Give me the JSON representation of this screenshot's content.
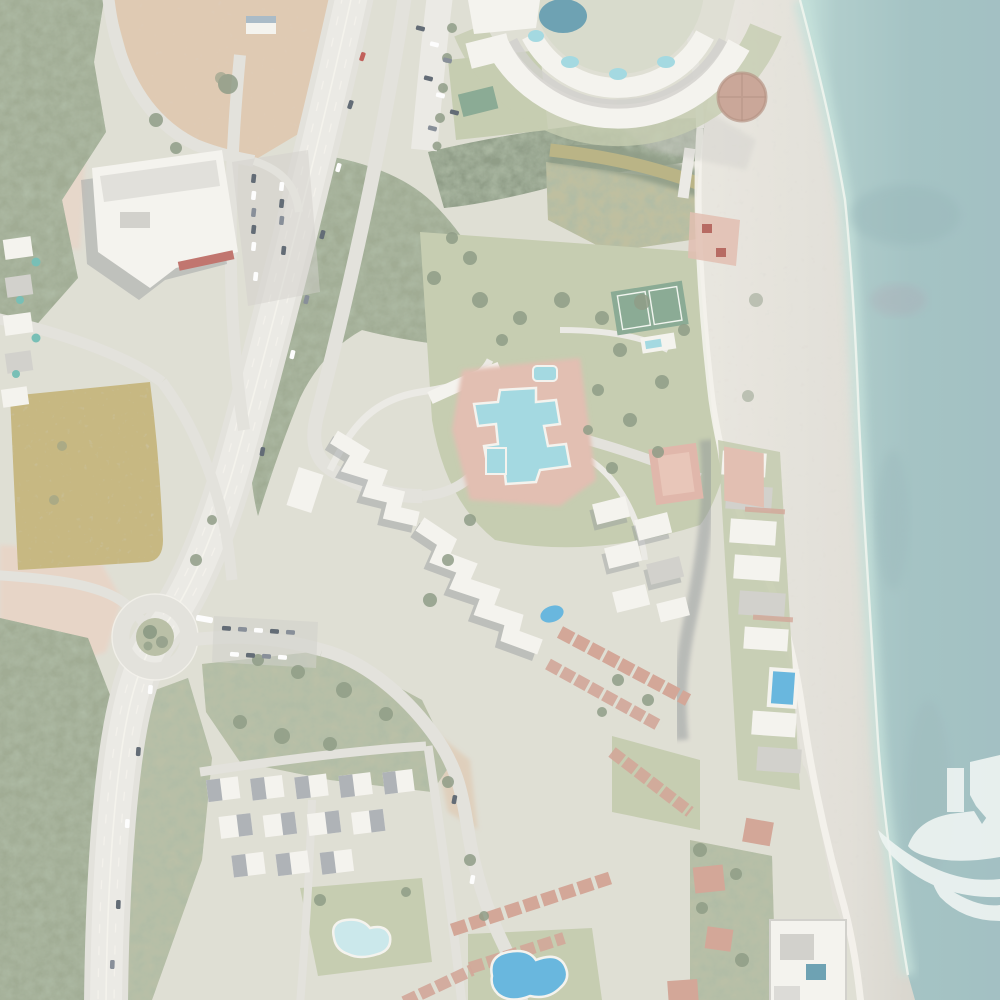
{
  "scene": {
    "type": "aerial-satellite-photograph",
    "description": "Washed-out aerial/satellite view of a Mediterranean beachfront resort town: teal sea and wide grey beach on the right, beachfront apartment rows with pools, a crescent-shaped resort complex at top, a central resort with a large free-form lagoon pool, a divided highway sweeping from top to bottom-left through a roundabout, an olive-green sports field, woods, dirt lots, and dense white housing clusters at the bottom. A white boat-and-waves watermark logo sits at the bottom-right edge over the water.",
    "orientation": "sea-on-right",
    "visible_text": "none"
  },
  "palette": {
    "land": "#d8d7ca",
    "woods": "#8a987a",
    "woods_dark": "#74856a",
    "scrub": "#a9b192",
    "grass": "#b8c19e",
    "lawn": "#c3c9a8",
    "field": "#b9a763",
    "marsh": "#b0b089",
    "dirt_tan": "#d8bda0",
    "dirt_pink": "#e2cbba",
    "road": "#dcdbd4",
    "road_lite": "#e7e5df",
    "paint_white": "#f2f0e8",
    "building_white": "#f2f0ea",
    "roof_gray": "#c7c6c0",
    "roof_dark": "#9ba1a6",
    "terracotta": "#c8917f",
    "shadow": "#6e767b",
    "pool_cyan": "#8ed0da",
    "pool_blue": "#44a6d6",
    "pool_navy": "#4a8ba0",
    "pool_teal": "#57b0a4",
    "river": "#a9a268",
    "beach": "#e0ddd4",
    "beach_wet": "#cfccc2",
    "sea_deep": "#8fb5b6",
    "sea_mid": "#9dc1bf",
    "sea_shallow": "#b7dad2",
    "foam": "#eef3ec",
    "accent_red": "#b23a32"
  },
  "overlay": {
    "haze_color": "#ffffff",
    "haze_opacity": "0.20"
  },
  "watermark": {
    "shape": "boat-with-waves-logo",
    "fill": "#edf3f1",
    "opacity": "0.92",
    "position": "bottom-right, clipped by right edge"
  },
  "features": {
    "sea": {
      "label": "Teal sea water with darker seagrass patches"
    },
    "shoreline": {
      "label": "Shoreline foam line"
    },
    "beach": {
      "label": "Wide grey sand and gravel beach"
    },
    "promenade": {
      "label": "Beach promenade path"
    },
    "river": {
      "label": "Brown-green stream reaching the beach"
    },
    "marsh": {
      "label": "Reedy marsh south of the stream"
    },
    "woods": {
      "label": "Dense dark-green woodland"
    },
    "field": {
      "label": "Olive-green sports field"
    },
    "dirt": {
      "label": "Bare earth construction lot"
    },
    "highway": {
      "label": "Divided highway curving from top to bottom-left"
    },
    "roundabout": {
      "label": "Roundabout with planted centre island"
    },
    "roads": {
      "label": "Local access roads"
    },
    "supermarket": {
      "label": "White flat-roof supermarket with car park"
    },
    "supermarket_parking": {
      "label": "Supermarket parking rows with cars"
    },
    "circular_resort": {
      "label": "Crescent-shaped resort building with terrace pools"
    },
    "round_plaza": {
      "label": "Round brown plaza structure"
    },
    "central_resort": {
      "label": "Zig-zag white resort apartment blocks"
    },
    "lagoon_pool": {
      "label": "Large free-form turquoise lagoon pool with pink deck"
    },
    "tennis_courts": {
      "label": "Green tennis courts"
    },
    "paddle_courts": {
      "label": "Salmon-pink sports courts"
    },
    "beachfront_row": {
      "label": "Row of beachfront apartment blocks"
    },
    "beachfront_pool": {
      "label": "Rectangular bright-blue beachfront pool"
    },
    "bottom_left_apartments": {
      "label": "Grid of white apartment blocks with dark roofs"
    },
    "kidney_pool": {
      "label": "Pale-blue kidney-shaped pool in lawn"
    },
    "freeform_pool": {
      "label": "Bright-blue free-form pool at bottom centre"
    },
    "townhouses": {
      "label": "Diagonal rows of terracotta-roofed townhouses"
    },
    "beach_compound": {
      "label": "Walled beachfront compound with dark pool"
    },
    "villas": {
      "label": "Red-roofed villas among trees"
    },
    "left_apartments": {
      "label": "Apartment strip with small teal pools on left edge"
    },
    "cars": {
      "label": "Cars on highway and parking areas"
    },
    "haze": {
      "label": "White haze overlay"
    },
    "watermark": {
      "label": "White boat-and-waves watermark logo"
    }
  }
}
